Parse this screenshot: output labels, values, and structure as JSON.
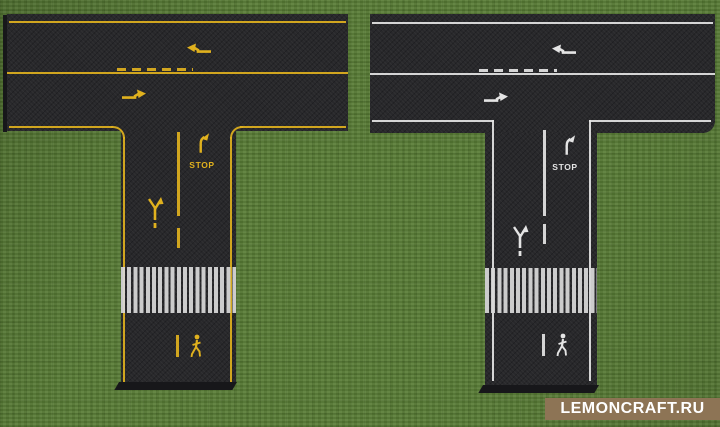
{
  "scene": {
    "grass_color": "#5a7d37",
    "asphalt_color": "#28282b",
    "edge_shadow_color": "#17171a"
  },
  "roads": [
    {
      "id": "yellow-marked-t-road",
      "marking_color": "#e0b11e",
      "crosswalk_color": "#d8d8d8",
      "stop_label": "STOP"
    },
    {
      "id": "white-marked-t-road",
      "marking_color": "#e4e4e4",
      "crosswalk_color": "#d8d8d8",
      "stop_label": "STOP"
    }
  ],
  "watermark": {
    "text": "LEMONCRAFT.RU",
    "bar_color": "#8d7455",
    "text_color": "#ffffff"
  }
}
